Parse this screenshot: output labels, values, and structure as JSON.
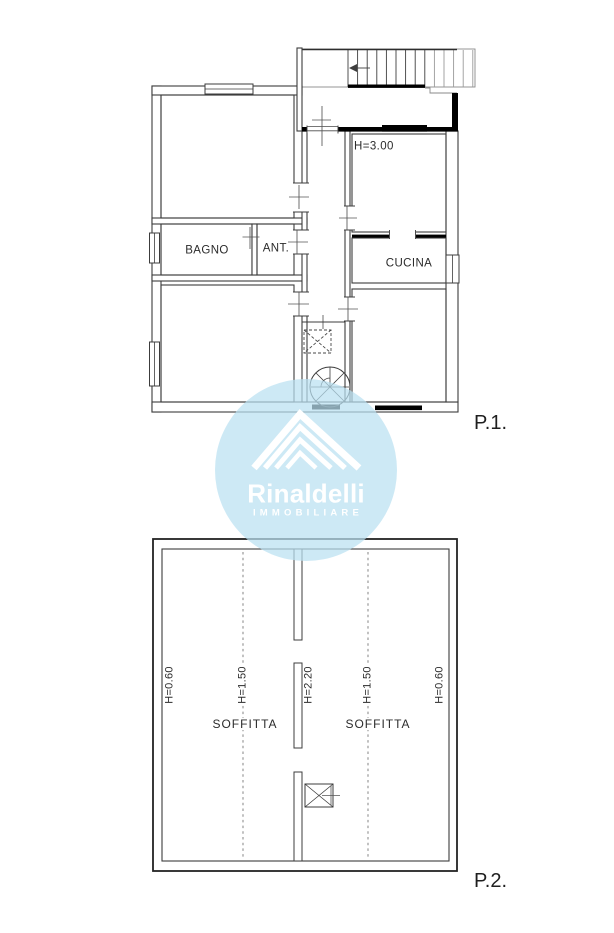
{
  "plan_p1": {
    "caption": "P.1.",
    "labels": {
      "bagno": "BAGNO",
      "ant": "ANT.",
      "cucina": "CUCINA",
      "ceiling_height": "H=3.00"
    }
  },
  "plan_p2": {
    "caption": "P.2.",
    "labels": {
      "soffitta_left": "SOFFITTA",
      "soffitta_right": "SOFFITTA"
    },
    "heights": [
      "H=0.60",
      "H=1.50",
      "H=2.20",
      "H=1.50",
      "H=0.60"
    ]
  },
  "watermark": {
    "brand": "Rinaldelli",
    "tagline": "IMMOBILIARE",
    "circle_color": "rgba(186,224,241,0.72)",
    "text_color": "#ffffff"
  },
  "colors": {
    "line": "#3c3c3c",
    "thick_line": "#000000",
    "dash_line": "#777777"
  }
}
